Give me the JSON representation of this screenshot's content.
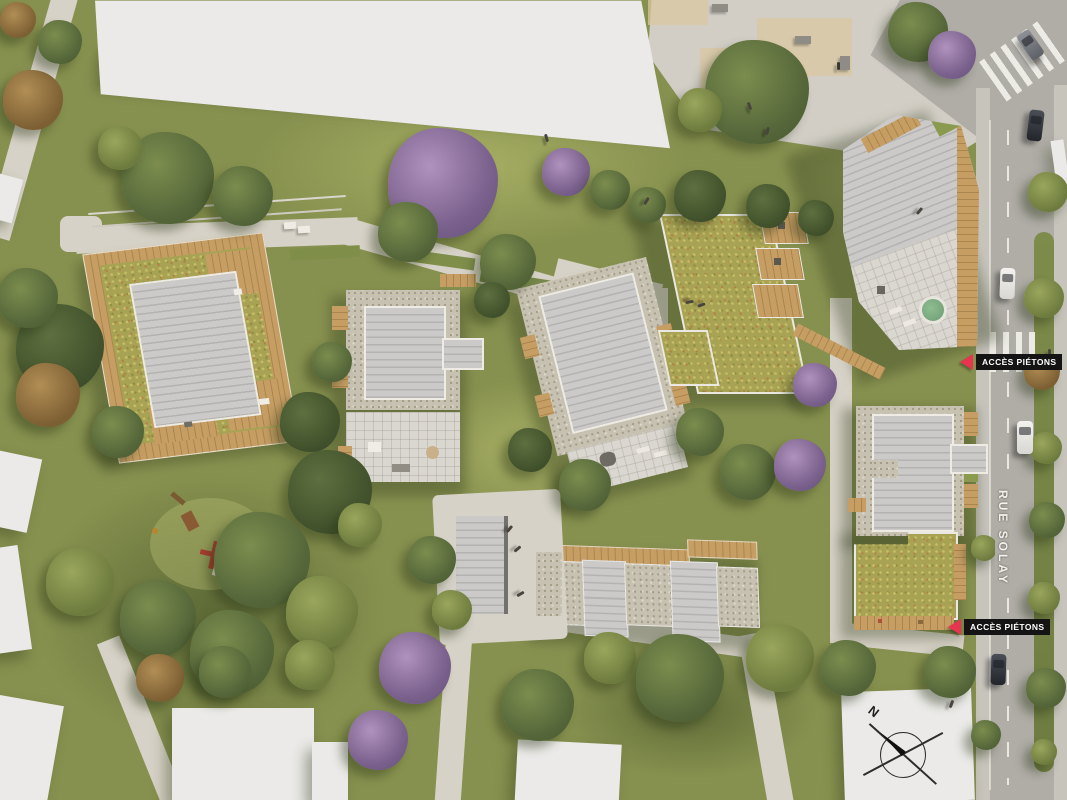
{
  "scene": {
    "description": "Aerial architectural site-plan rendering of a residential development with landscaped grounds, a playground, pedestrian paths and a bordering street"
  },
  "labels": {
    "access_top": "ACCÈS PIÉTONS",
    "access_bottom": "ACCÈS PIÉTONS",
    "street_name": "RUE SOLAY",
    "compass_north": "N"
  },
  "colors": {
    "grass": "#87914f",
    "path": "#d7d2c7",
    "plaza": "#d2cec6",
    "plaza_tan": "#d9c7a0",
    "road": "#b0ada7",
    "sidewalk": "#c7c4bc",
    "median_green": "#7d8b4b",
    "roof_gray": "#c1c0be",
    "roof_gravel": "#c7c1b2",
    "roof_green": "#a8a254",
    "deck_wood": "#c69e64",
    "building_white": "#ebeae8",
    "label_background": "#141414",
    "label_text": "#ffffff",
    "accent_red": "#e73550",
    "hot_tub_green": "#7fb083",
    "car_dark": "#22252a",
    "car_white": "#f3f2ef"
  }
}
